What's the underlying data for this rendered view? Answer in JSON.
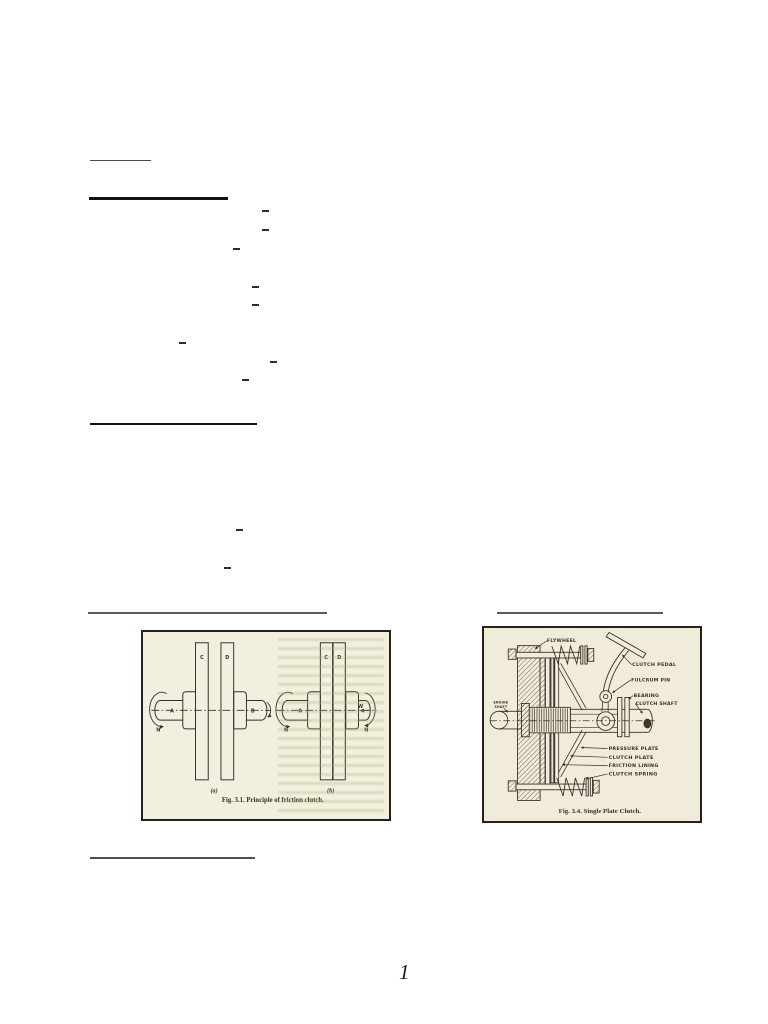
{
  "page": {
    "number": "1"
  },
  "figure_1": {
    "caption": "Fig. 3.1. Principle of friction clutch.",
    "sub_a": "(a)",
    "sub_b": "(b)",
    "disc_c": "C",
    "disc_d": "D",
    "shaft_a": "A",
    "shaft_b": "B",
    "speed_n": "N",
    "force_w": "W"
  },
  "figure_2": {
    "caption": "Fig. 3.4. Single Plate Clutch.",
    "labels": {
      "flywheel": "FLYWHEEL",
      "clutch_pedal": "CLUTCH PEDAL",
      "fulcrum_pin": "FULCRUM PIN",
      "bearing": "BEARING",
      "clutch_shaft": "CLUTCH SHAFT",
      "engine_shaft_line1": "ENGINE",
      "engine_shaft_line2": "SHAFT",
      "pressure_plate": "PRESSURE PLATE",
      "clutch_plate": "CLUTCH PLATE",
      "friction_lining": "FRICTION LINING",
      "clutch_spring": "CLUTCH SPRING"
    }
  },
  "colors": {
    "figure_paper": "#f1ecd9",
    "ink": "#36302a"
  }
}
